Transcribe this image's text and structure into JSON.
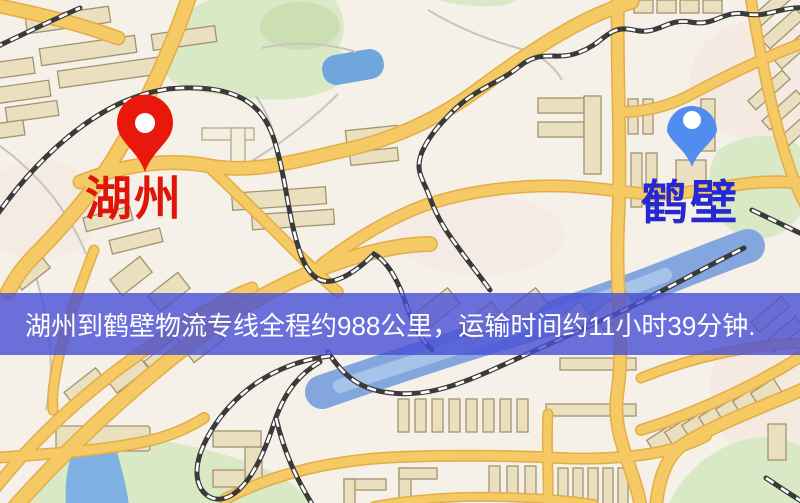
{
  "map": {
    "markers": [
      {
        "id": "origin",
        "label": "湖州",
        "pin_color": "#e8190c",
        "label_color": "#de1507"
      },
      {
        "id": "destination",
        "label": "鹤壁",
        "pin_color": "#518cf0",
        "label_color": "#2729d0"
      }
    ],
    "banner": {
      "text": "湖州到鹤壁物流专线全程约988公里，运输时间约11小时39分钟."
    }
  },
  "colors": {
    "map_bg": "#f6f1e8",
    "road": "#f5c963",
    "road_casing": "#e3ad49",
    "park": "#d9e8c5",
    "water": "#7fb2e2",
    "river": "#84a6df",
    "building": "#eadfbe",
    "building_outline": "#a2946f",
    "rail": "#3a3a3a",
    "banner_bg": "rgba(73,79,212,0.8)",
    "banner_text": "#ffffff",
    "pin_red": "#e8190c",
    "label_red": "#de1507",
    "pin_blue": "#518cf0",
    "label_blue": "#2729d0"
  }
}
